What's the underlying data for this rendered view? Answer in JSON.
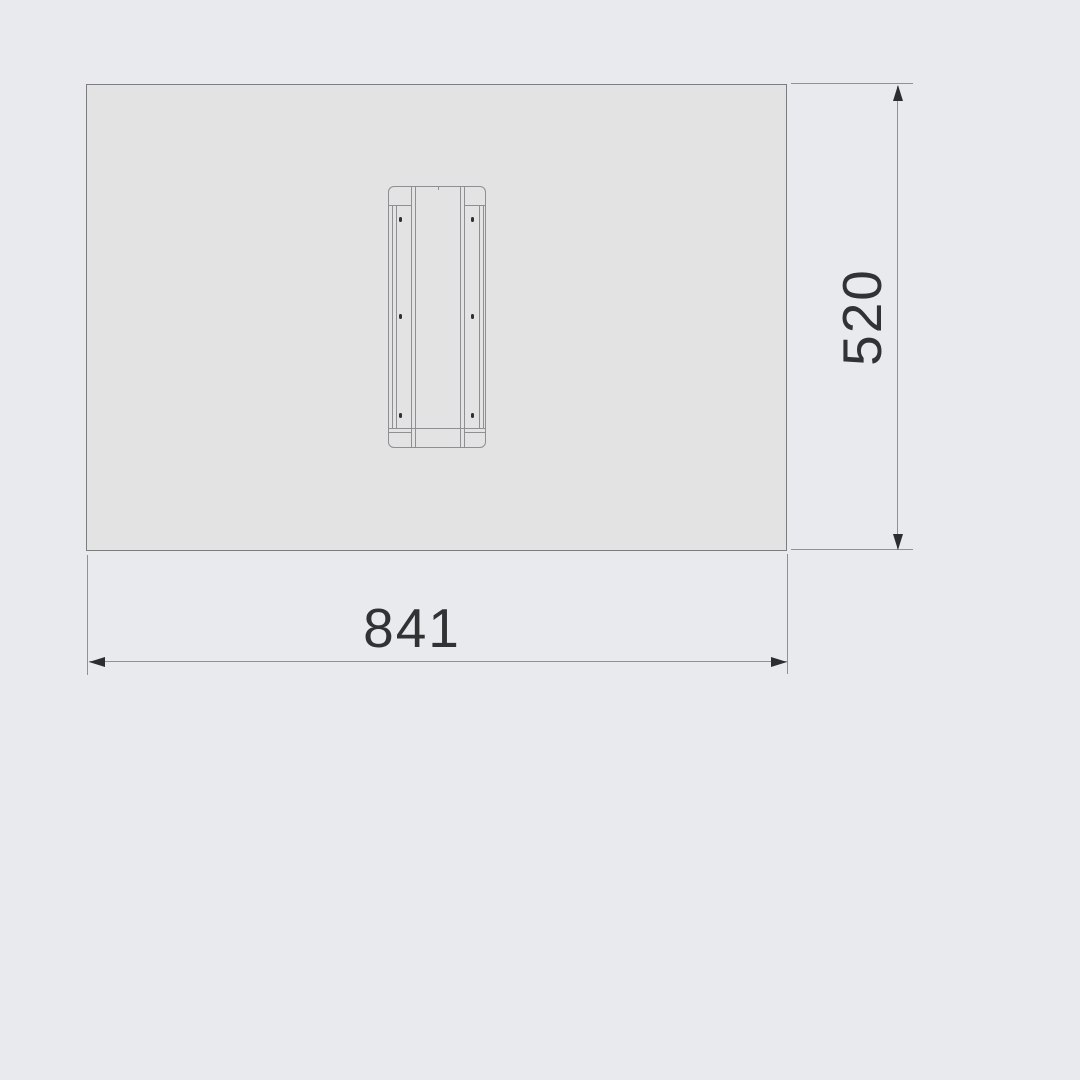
{
  "dimensions": {
    "width_label": "841",
    "height_label": "520"
  },
  "colors": {
    "background": "#e8eaed",
    "panel_fill": "#e2e3e2",
    "panel_border": "#7b7d80",
    "detail_line": "#8d8f92",
    "dimension_line": "#8f9194",
    "arrow": "#2b2d2f",
    "label_text": "#303234"
  }
}
